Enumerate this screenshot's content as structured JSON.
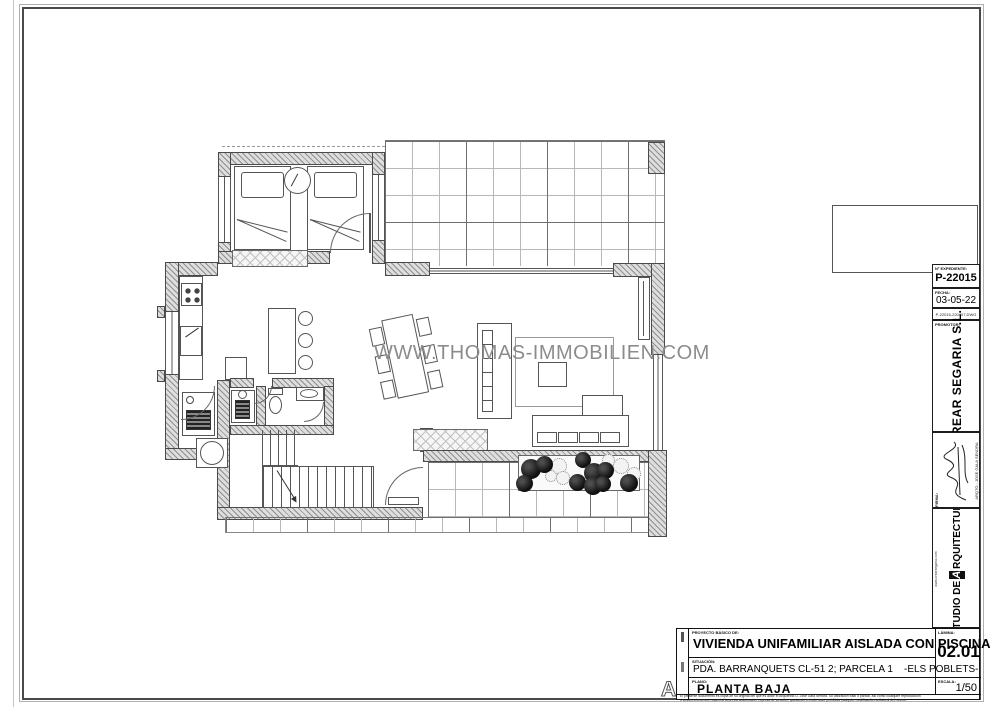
{
  "watermark": "WWW.THOMAS-IMMOBILIEN.COM",
  "info_strip": {
    "expediente_label": "Nº EXPEDIENTE:",
    "expediente": "P-22015",
    "fecha_label": "FECHA:",
    "fecha": "03-05-22",
    "file_name": "P-22015-220407.DWG",
    "promotor_label": "PROMOTOR:",
    "promotor": "CREAR SEGARIA S.L.",
    "firma_label": "FIRMA:",
    "arquitecto": "ARQTO.: JOSE GALA SENDRA",
    "estudio_prefix": "ESTUDIO DE",
    "estudio_logo_letter": "A",
    "estudio_suffix": "RQUITECTURA",
    "web": "www.crearsegaria.com"
  },
  "title_block": {
    "proyecto_label": "PROYECTO BÁSICO DE:",
    "proyecto": "VIVIENDA UNIFAMILIAR AISLADA CON PISCINA",
    "situacion_label": "SITUACIÓN:",
    "situacion": "PDA. BARRANQUETS CL-51 2; PARCELA 1    -ELS POBLETS-",
    "plano_label": "PLANO:",
    "plano": "PLANTA BAJA",
    "lamina_label": "LÁMINA:",
    "lamina": "02.01",
    "escala_label": "ESCALA:",
    "escala": "1/50",
    "logo_letter": "A",
    "disclaimer_line1": "El presente documento es copia de su original del que es autor el Arquitecto D. José Gala Sendra. Su utilización total o parcial, así como cualquier reproducción",
    "disclaimer_line2": "o cesión a terceros, requerirá la previa autorización expresa de su autor, quedando en todo caso prohibida cualquier modificación unilateral del mismo."
  }
}
